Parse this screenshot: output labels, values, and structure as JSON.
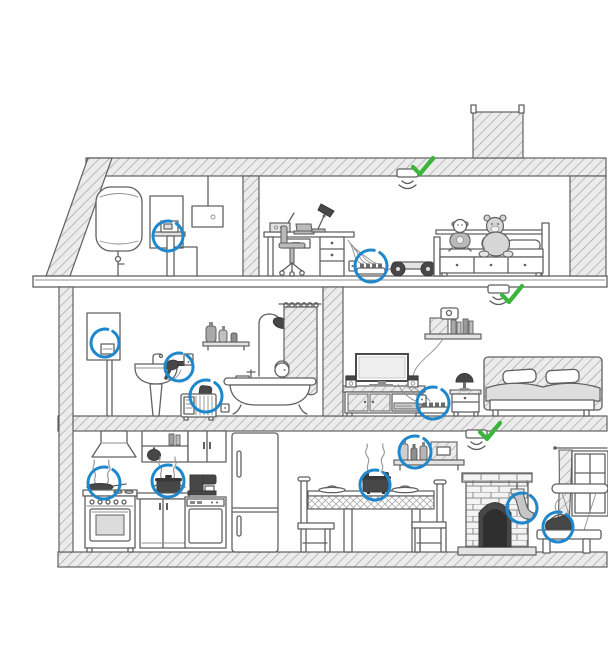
{
  "meta": {
    "description": "Hand-drawn pencil-sketch cutaway of a two-storey house with attic; household electrical and fire-risk items are ringed with blue highlight circles and three ceiling-mounted wireless detectors are marked with green verification checkmarks."
  },
  "palette": {
    "paper": "#ffffff",
    "ink": "#606060",
    "ink_light": "#9c9c9c",
    "wall_fill": "#ececec",
    "dark": "#474747",
    "mid": "#bababa",
    "highlight_blue": "#1f87cb",
    "check_green": "#3cb53c"
  },
  "rooms": [
    {
      "id": "attic",
      "label": "attic",
      "items": [
        "water-heater-tank",
        "fuse-panel",
        "power-meter",
        "junction-box"
      ]
    },
    {
      "id": "kids-room",
      "label": "kids room",
      "items": [
        "desk",
        "radio",
        "laptop",
        "desk-lamp",
        "office-chair",
        "power-strip",
        "hoverboard",
        "kids-bed",
        "toy-doll",
        "teddy-bear"
      ]
    },
    {
      "id": "bathroom",
      "label": "bathroom",
      "items": [
        "wall-boiler",
        "pedestal-sink",
        "hair-dryer",
        "wall-outlet",
        "portable-heater",
        "shelf-bottles",
        "shower",
        "shower-curtain",
        "bathtub",
        "person-bathing",
        "towel"
      ]
    },
    {
      "id": "living-bedroom",
      "label": "living room / bedroom",
      "items": [
        "book-shelf",
        "router",
        "tv",
        "tv-stand",
        "speakers",
        "power-strip",
        "nightstand",
        "table-lamp",
        "double-bed"
      ]
    },
    {
      "id": "kitchen",
      "label": "kitchen",
      "items": [
        "range-hood",
        "frying-pan",
        "stove-oven",
        "upper-cabinets",
        "pot-on-counter",
        "counter-cabinet",
        "coffee-machine",
        "dishwasher",
        "fridge"
      ]
    },
    {
      "id": "dining",
      "label": "dining area",
      "items": [
        "dining-table",
        "chair-left",
        "chair-right",
        "pot-on-table",
        "spice-shelf"
      ]
    },
    {
      "id": "fireplace-corner",
      "label": "fireplace corner",
      "items": [
        "fireplace",
        "stocking",
        "window",
        "window-curtain",
        "bench",
        "iron",
        "ironing-board"
      ]
    }
  ],
  "hotspots": [
    {
      "id": "power-meter",
      "label": "power meter in attic",
      "cx": 168,
      "cy": 236,
      "r": 15
    },
    {
      "id": "boiler-gauge",
      "label": "wall boiler gauge",
      "cx": 105,
      "cy": 343,
      "r": 14
    },
    {
      "id": "hair-dryer",
      "label": "hair dryer plugged in by sink",
      "cx": 179,
      "cy": 367,
      "r": 14
    },
    {
      "id": "portable-heater",
      "label": "portable heater in bathroom",
      "cx": 206,
      "cy": 396,
      "r": 16
    },
    {
      "id": "power-strip-kids",
      "label": "overloaded power strip in kids room",
      "cx": 371,
      "cy": 266,
      "r": 16
    },
    {
      "id": "power-strip-living",
      "label": "power strip behind tv",
      "cx": 433,
      "cy": 403,
      "r": 16
    },
    {
      "id": "frying-pan",
      "label": "steaming pan on stove",
      "cx": 104,
      "cy": 483,
      "r": 16
    },
    {
      "id": "pot-counter",
      "label": "steaming pot on counter",
      "cx": 168,
      "cy": 481,
      "r": 16
    },
    {
      "id": "pot-table",
      "label": "hot pot on dining table",
      "cx": 375,
      "cy": 485,
      "r": 15
    },
    {
      "id": "shelf-bottles",
      "label": "bottles on wall shelf",
      "cx": 415,
      "cy": 452,
      "r": 16
    },
    {
      "id": "stocking",
      "label": "stocking hanging on fireplace",
      "cx": 522,
      "cy": 508,
      "r": 15
    },
    {
      "id": "iron",
      "label": "hot iron on bench",
      "cx": 558,
      "cy": 527,
      "r": 15
    }
  ],
  "sensors": [
    {
      "id": "sensor-attic",
      "label": "wireless detector under roof",
      "x": 397,
      "y": 169,
      "check_dx": 16,
      "check_dy": -11,
      "status": "checked"
    },
    {
      "id": "sensor-second-floor",
      "label": "wireless detector under kids room floor",
      "x": 488,
      "y": 285,
      "check_dx": 14,
      "check_dy": 1,
      "status": "checked"
    },
    {
      "id": "sensor-first-floor",
      "label": "wireless detector under living room floor",
      "x": 466,
      "y": 430,
      "check_dx": 14,
      "check_dy": -7,
      "status": "checked"
    }
  ]
}
